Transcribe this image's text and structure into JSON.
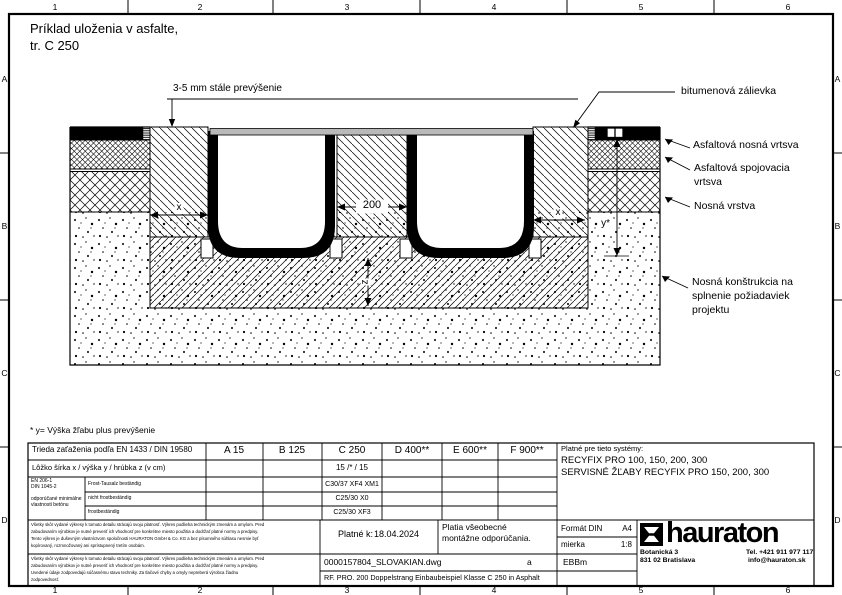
{
  "sheet": {
    "cols": [
      "1",
      "2",
      "3",
      "4",
      "5",
      "6"
    ],
    "rows": [
      "A",
      "B",
      "C",
      "D"
    ]
  },
  "title": {
    "line1": "Príklad uloženia v asfalte,",
    "line2": "tr. C 250"
  },
  "section": {
    "annotation": "3-5 mm stále prevýšenie",
    "label_bitumen": "bitumenová zálievka",
    "label_asphalt_base": "Asfaltová nosná vrtsva",
    "label_asphalt_binder_1": "Asfaltová spojovacia",
    "label_asphalt_binder_2": "vrtsva",
    "label_base_course": "Nosná vrstva",
    "label_substructure_1": "Nosná konštrukcia na",
    "label_substructure_2": "splnenie požiadaviek",
    "label_substructure_3": "projektu",
    "dim_gap": "200",
    "dim_x_left": "x",
    "dim_x_right": "x",
    "dim_y": "y*",
    "dim_z": "z",
    "footnote": "* y= Výška žľabu plus prevýšenie"
  },
  "table": {
    "load_class_label": "Trieda zaťaženia podľa EN 1433 / DIN 19580",
    "classes": [
      "A 15",
      "B 125",
      "C 250",
      "D 400**",
      "E 600**",
      "F 900**"
    ],
    "size_label": "Lôžko šírka x / výška y / hrúbka z (v cm)",
    "size_c250": "15 /* / 15",
    "concrete_std_1": "EN 206-1",
    "concrete_std_2": "DIN 1045-2",
    "concrete_note_1": "odporúčané minimálne",
    "concrete_note_2": "vlastnosti betónu",
    "concrete_rows": [
      {
        "label": "Frost-Tausalz beständig",
        "c250": "C30/37 XF4 XM1"
      },
      {
        "label": "nicht frostbeständig",
        "c250": "C25/30 X0"
      },
      {
        "label": "frostbeständig",
        "c250": "C25/30 XF3"
      }
    ],
    "systems_title": "Platné pre tieto systémy:",
    "systems_1": "RECYFIX PRO 100, 150, 200, 300",
    "systems_2": "SERVISNÉ ŽĽABY RECYFIX PRO 150, 200, 300"
  },
  "titleblock": {
    "fine_print_1": [
      "Všetky skôr vydané výkresy k tomuto detailu strácajú svoju platnosť. Výkres podlieha technickým zmenám a omylom. Pred",
      "zabudovaním výrobkov je nutné preveriť ich vhodnosť pre konkrétne miesto použitia a dodržať platné normy a predpisy.",
      "Tento výkres je duševným vlastníctvom spoločnosti HAURATON GmbH & Co. KG a bez písomného súhlasu nesmie byť",
      "kopírovaný, rozmnožovaný ani sprístupnený tretím osobám."
    ],
    "fine_print_2": [
      "Všetky skôr vydané výkresy k tomuto detailu strácajú svoju platnosť. Výkres podlieha technickým zmenám a omylom. Pred",
      "zabudovaním výrobkov je nutné preveriť ich vhodnosť pre konkrétne miesto použitia a dodržať platné normy a predpisy.",
      "Uvedené údaje zodpovedajú súčasnému stavu techniky. Za tlačové chyby a omyly nepreberá výrobca žiadnu",
      "zodpovednosť."
    ],
    "valid_label": "Platné k:",
    "valid_date": "18.04.2024",
    "note_1": "Platia všeobecné",
    "note_2": "montážne odporúčania.",
    "file_name": "0000157804_SLOVAKIAN.dwg",
    "revision": "a",
    "description": "RF. PRO. 200 Doppelstrang Einbaubeispiel Klasse C 250 in Asphalt",
    "format_label": "Formát DIN",
    "format_value": "A4",
    "scale_label": "mierka",
    "scale_value": "1:8",
    "author": "EBBm",
    "brand_name": "hauraton",
    "address_1": "Botanická 3",
    "address_2": "831 02 Bratislava",
    "phone": "Tel. +421 911 977 117",
    "email": "info@hauraton.sk"
  },
  "colors": {
    "paper": "#ffffff",
    "ink": "#000000",
    "grating": "#b9b9b9"
  }
}
